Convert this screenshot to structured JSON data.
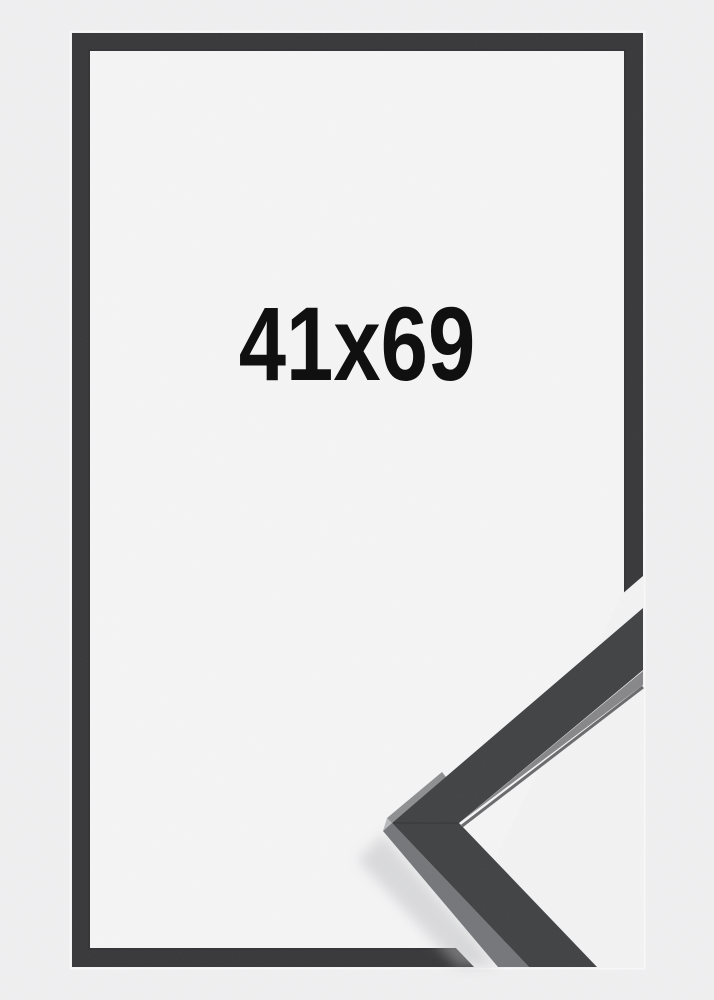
{
  "product_image": {
    "size_label": "41x69"
  },
  "colors": {
    "background": "#f0f0f1",
    "inner_background": "#f5f5f6",
    "gap_background": "#f3f3f4",
    "halo": "#fafafb",
    "frame": "#38383a",
    "frame_inner_edge": "#2b2b2d",
    "profile_front": "#414244",
    "profile_inner_face": "#87878a",
    "profile_outer_face": "#75767a",
    "profile_tip_face": "#7b7c7f",
    "profile_edge_line": "#2f2f32",
    "shadow": "#b9babc",
    "label_text": "#101011"
  }
}
